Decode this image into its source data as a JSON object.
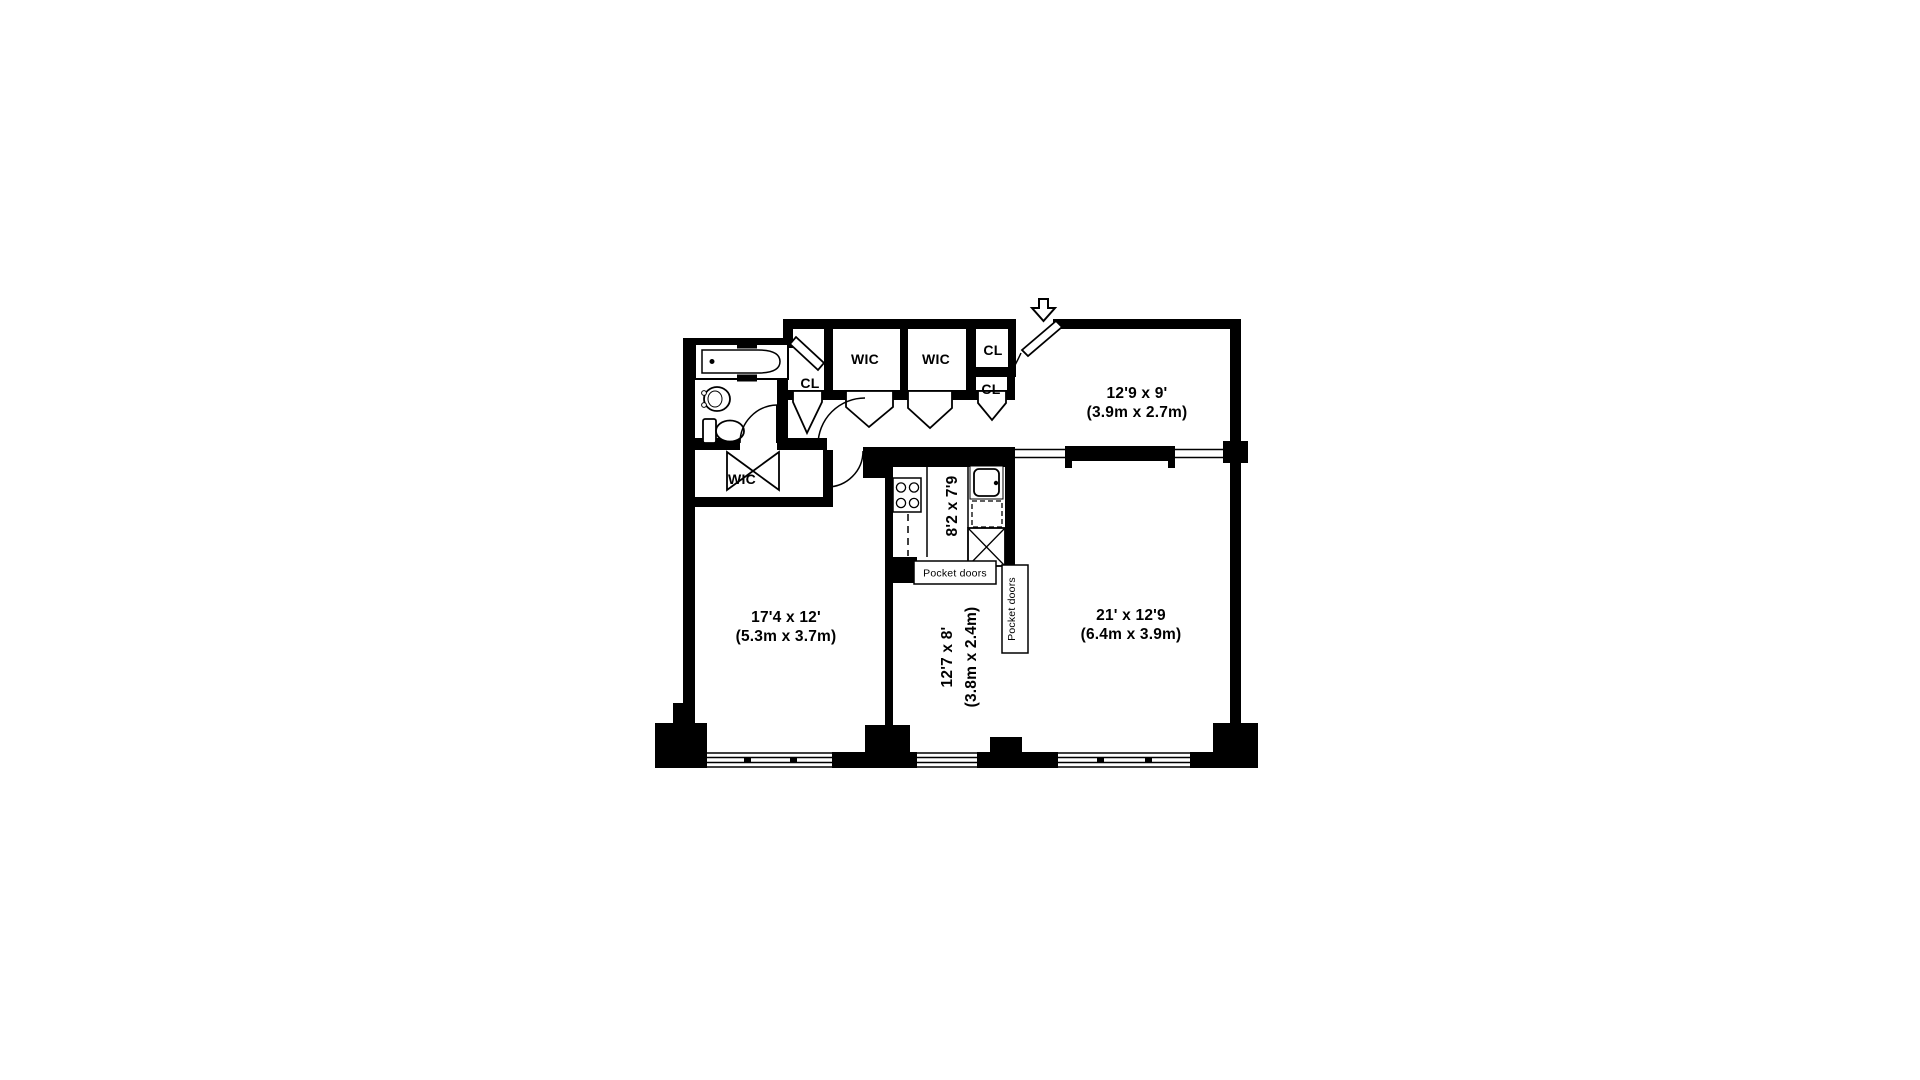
{
  "title": "Apartment floor plan",
  "colors": {
    "ink": "#000000",
    "background": "#ffffff"
  },
  "rooms": {
    "foyer": {
      "dims_ft": "12'9 x 9'",
      "dims_m": "(3.9m x 2.7m)"
    },
    "living": {
      "dims_ft": "21' x 12'9",
      "dims_m": "(6.4m x 3.9m)"
    },
    "bedroom": {
      "dims_ft": "17'4 x 12'",
      "dims_m": "(5.3m x 3.7m)"
    },
    "dining": {
      "dims_ft": "12'7 x 8'",
      "dims_m": "(3.8m x 2.4m)"
    },
    "kitchen": {
      "dims_ft": "8'2 x 7'9"
    }
  },
  "closets": {
    "wic_hall_left": "WIC",
    "wic_hall_right": "WIC",
    "cl_entry_top": "CL",
    "cl_entry_bottom": "CL",
    "cl_linen": "CL",
    "wic_bedroom": "WIC"
  },
  "doors": {
    "pocket_kitchen": "Pocket doors",
    "pocket_living": "Pocket doors"
  }
}
